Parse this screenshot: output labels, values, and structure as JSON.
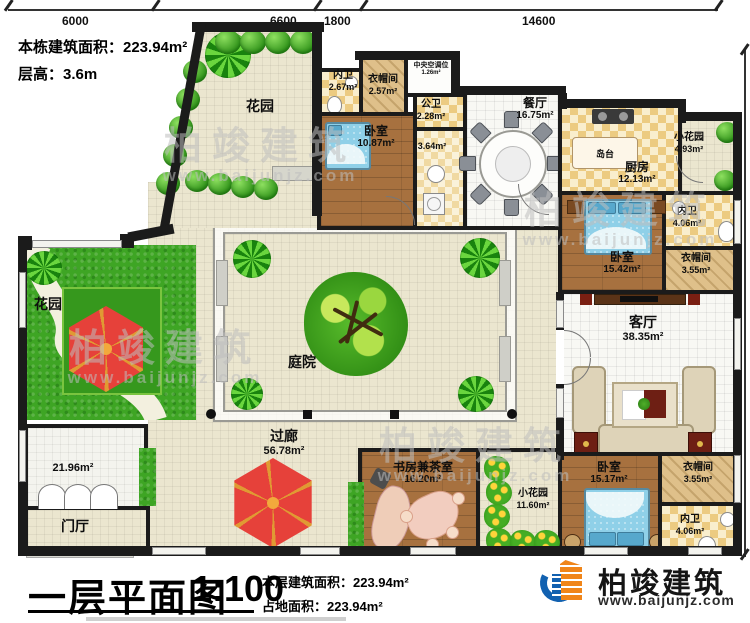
{
  "meta_info": {
    "building_area": "本栋建筑面积：223.94m²",
    "floor_height": "层高：3.6m"
  },
  "dimensions": {
    "top": [
      "6000",
      "6600",
      "1800",
      "14600"
    ],
    "right": "20440"
  },
  "rooms": {
    "garden_top": {
      "name": "花园"
    },
    "bath_top": {
      "name": "内卫",
      "area": "2.67m²"
    },
    "cloak_top": {
      "name": "衣帽间",
      "area": "2.57m²"
    },
    "hvac": {
      "name": "中央空调位",
      "area": "1.26m²"
    },
    "bedroom_top": {
      "name": "卧室",
      "area": "10.87m²"
    },
    "bath_public": {
      "name": "公卫",
      "area": "2.28m²"
    },
    "hall_364": {
      "area": "3.64m²"
    },
    "dining": {
      "name": "餐厅",
      "area": "16.75m²"
    },
    "island": {
      "name": "岛台"
    },
    "kitchen": {
      "name": "厨房",
      "area": "12.13m²"
    },
    "garden_small_tr": {
      "name": "小花园",
      "area": "4.93m²"
    },
    "bath_right": {
      "name": "内卫",
      "area": "4.06m²"
    },
    "bedroom_right": {
      "name": "卧室",
      "area": "15.42m²"
    },
    "cloak_right": {
      "name": "衣帽间",
      "area": "3.55m²"
    },
    "living": {
      "name": "客厅",
      "area": "38.35m²"
    },
    "courtyard": {
      "name": "庭院"
    },
    "corridor": {
      "name": "过廊",
      "area": "56.78m²"
    },
    "garden_left": {
      "name": "花园"
    },
    "patio": {
      "area": "21.96m²"
    },
    "foyer": {
      "name": "门厅"
    },
    "study": {
      "name": "书房兼茶室",
      "area": "16.20m²"
    },
    "garden_small_b": {
      "name": "小花园",
      "area": "11.60m²"
    },
    "bedroom_b": {
      "name": "卧室",
      "area": "15.17m²"
    },
    "cloak_b": {
      "name": "衣帽间",
      "area": "3.55m²"
    },
    "bath_b": {
      "name": "内卫",
      "area": "4.06m²"
    }
  },
  "title_block": {
    "title": "一层平面图",
    "scale": "1:100",
    "floor_area": "本层建筑面积：223.94m²",
    "land_area": "占地面积：223.94m²"
  },
  "brand": {
    "logo_text": "柏竣建筑",
    "website": "www.baijunjz.com"
  },
  "watermark": {
    "text": "柏竣建筑",
    "website": "www.baijunjz.com"
  },
  "colors": {
    "wall": "#1b1b1b",
    "grass": "#3ea524",
    "umbrella_red": "#e6413a",
    "bed_blue": "#8fd0e8",
    "wood": "#a7713f",
    "logo_blue": "#1261b0",
    "logo_orange": "#f08519"
  }
}
